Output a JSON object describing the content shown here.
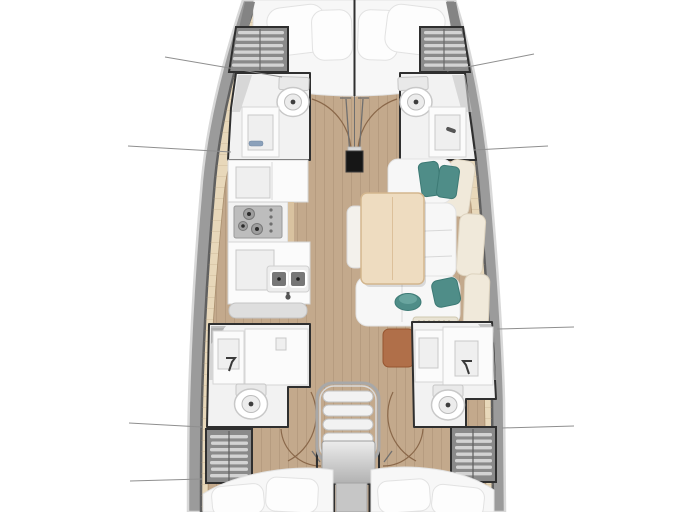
{
  "diagram": {
    "kind": "sailboat-interior-floor-plan",
    "view": "top-down, bow at top",
    "areas": [
      {
        "id": "v-berth",
        "label": "forward V-berth with four pillows"
      },
      {
        "id": "port-forward-head",
        "label": "port forward head: toilet and vanity sink"
      },
      {
        "id": "starboard-forward-head",
        "label": "starboard forward head: toilet and vanity sink"
      },
      {
        "id": "galley",
        "label": "port galley: cabinets, 3-burner stove, double sink"
      },
      {
        "id": "salon",
        "label": "starboard salon: U-settee with teal cushions and wood table"
      },
      {
        "id": "port-aft-head",
        "label": "port aft head: shower, sink, toilet"
      },
      {
        "id": "starboard-aft-head",
        "label": "starboard aft head: shower, sink, toilet"
      },
      {
        "id": "companionway",
        "label": "central companionway with four steps and landing"
      },
      {
        "id": "port-aft-cabin",
        "label": "port aft cabin double berth"
      },
      {
        "id": "starboard-aft-cabin",
        "label": "starboard aft cabin double berth"
      },
      {
        "id": "storage-lockers",
        "label": "four slatted storage lockers along hull"
      },
      {
        "id": "mast-post",
        "label": "mast post on centerline"
      }
    ],
    "callout_leader_lines": 8
  },
  "colors": {
    "hullband": "#9b9b9b",
    "hulledge": "#d8d8d8",
    "hullinner": "#606060",
    "deck": "#e8d8ba",
    "wood": "#c3a98c",
    "wall": "#2f2f2f",
    "locker": "#8a8a8a",
    "slat": "#d3d3d3",
    "teal": "#4f8d88",
    "tealdark": "#3d7a75",
    "sienna": "#b06f49",
    "table": "#eedcc0",
    "tableedge": "#d3b68e",
    "cream": "#f0e9da",
    "arc": "#8a684a",
    "leader": "#8f8f8f"
  }
}
